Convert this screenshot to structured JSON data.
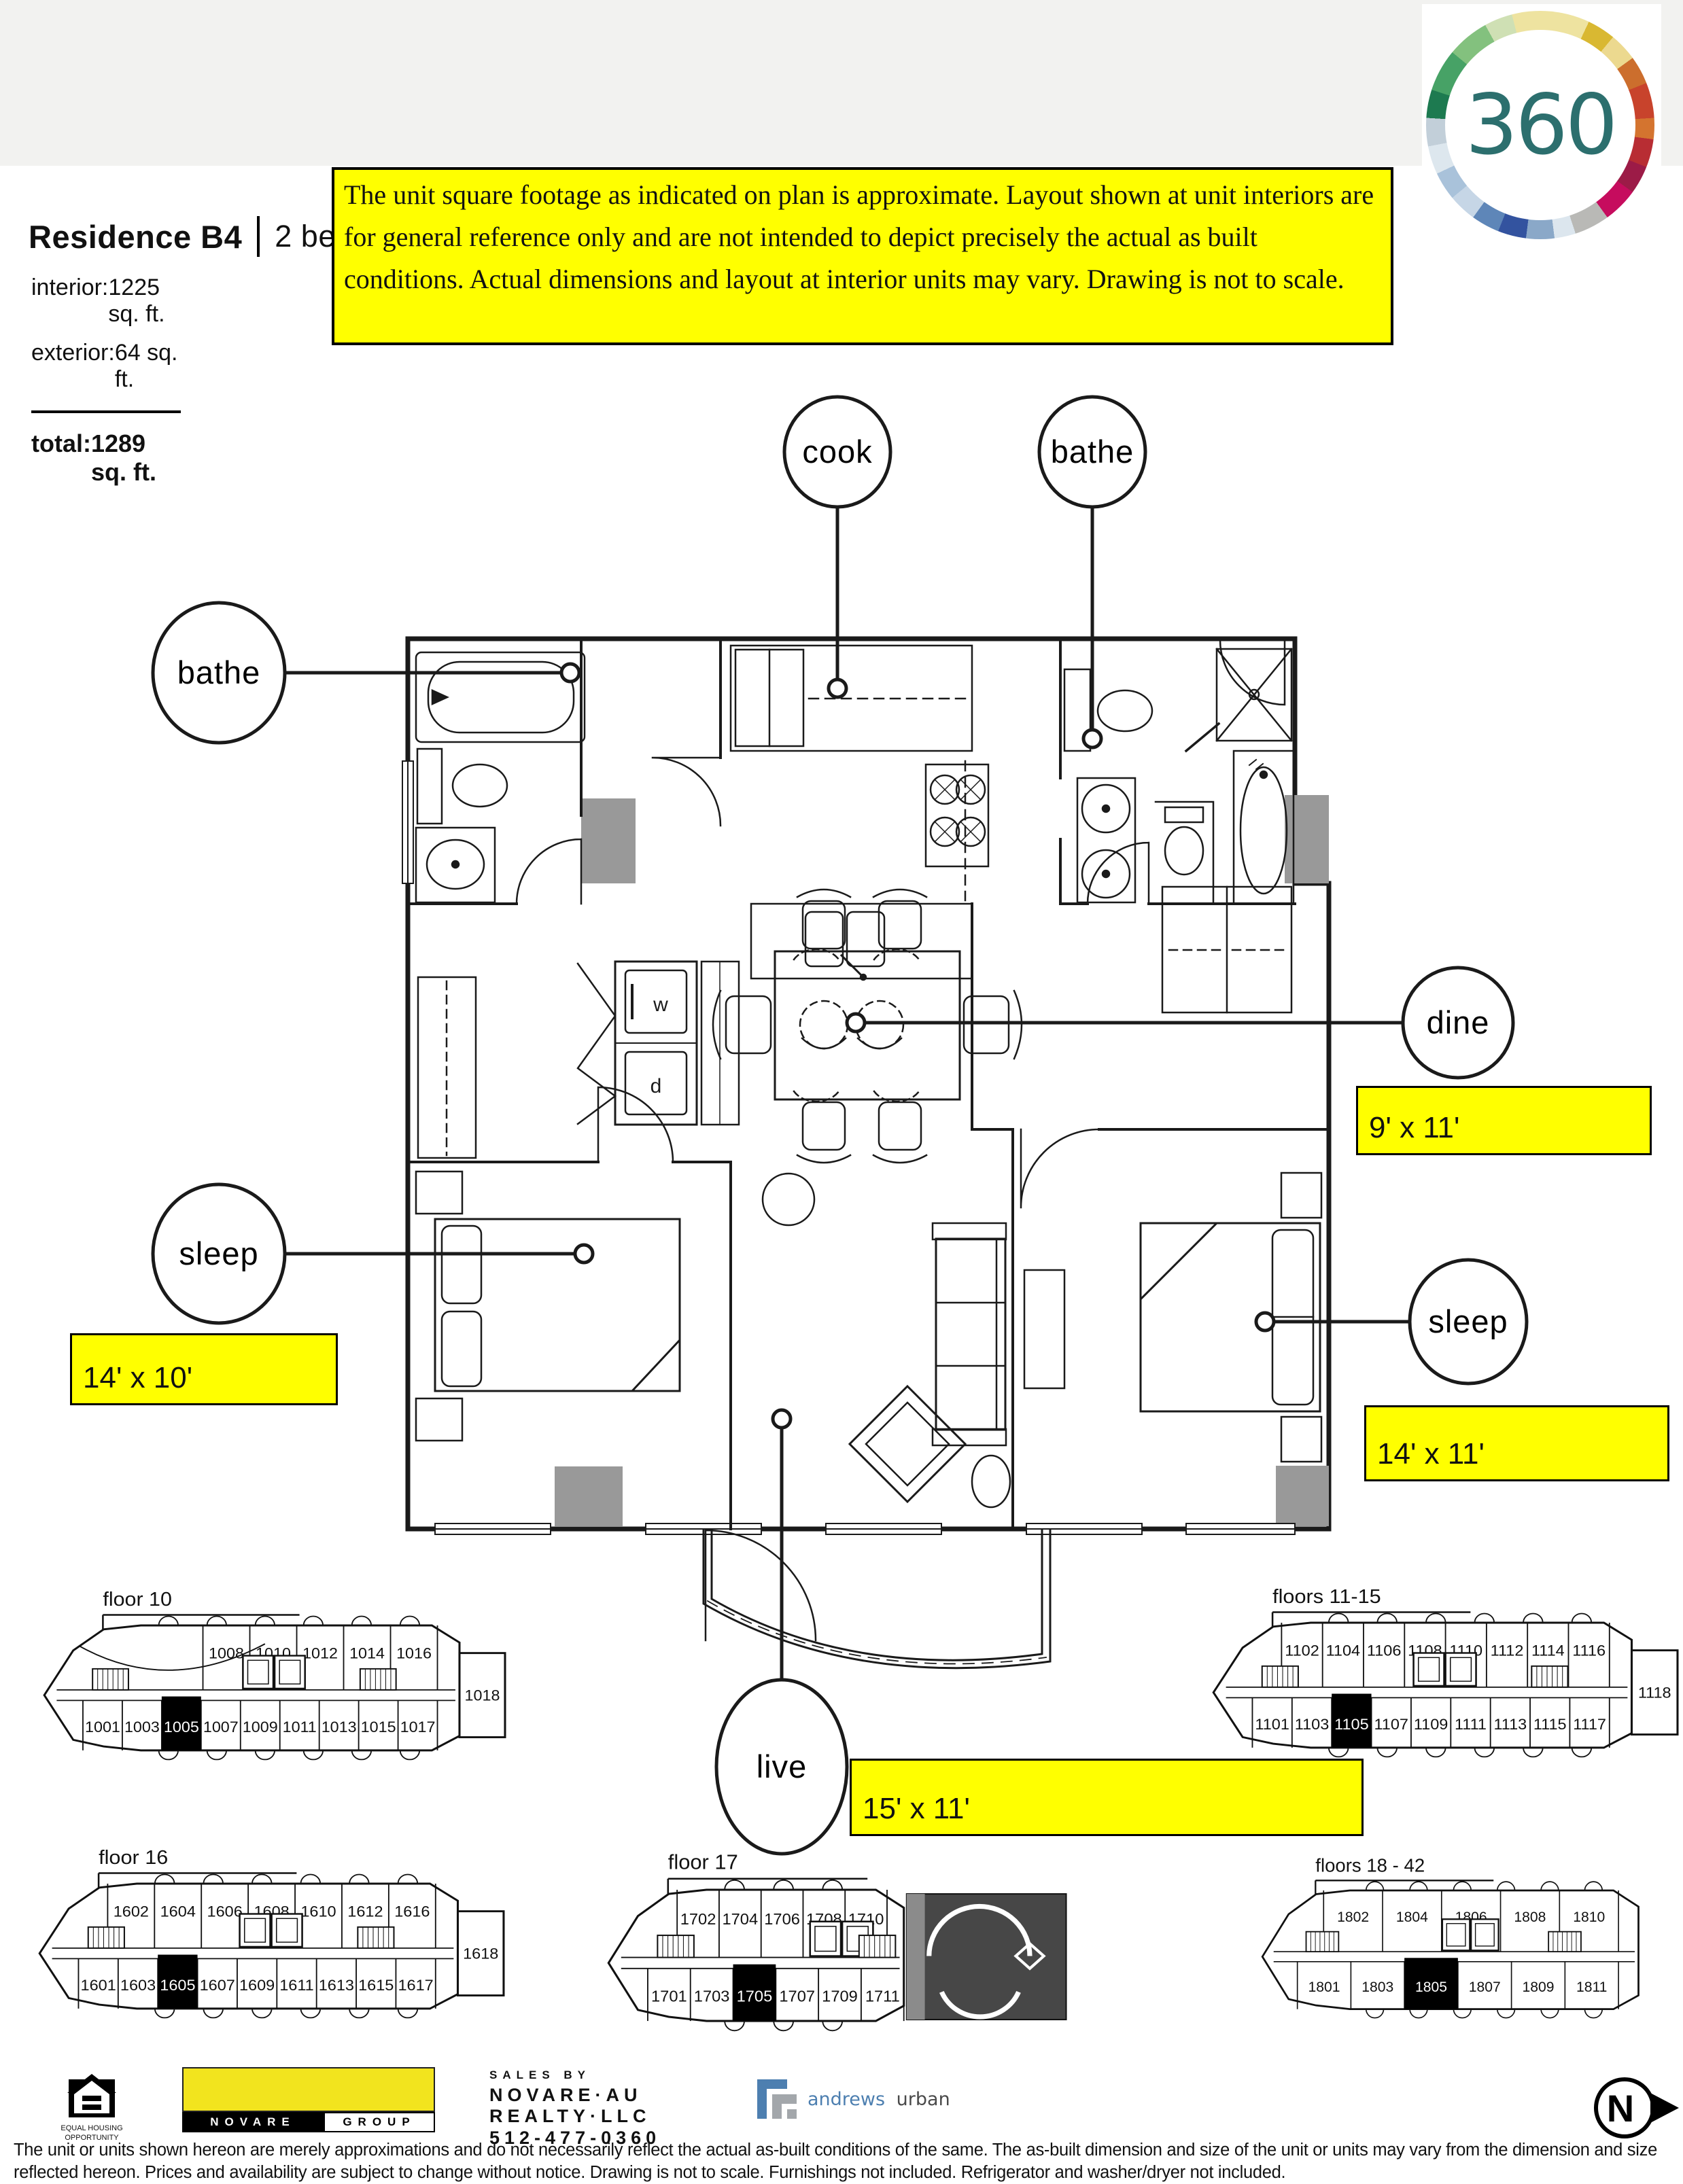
{
  "header": {
    "residence": "Residence B4",
    "subtitle": "2 bedroom + 2 bath",
    "stats": [
      {
        "label": "interior:",
        "value": "1225 sq. ft."
      },
      {
        "label": "exterior:",
        "value": "64 sq. ft."
      }
    ],
    "total_label": "total:",
    "total_value": "1289 sq. ft.",
    "disclaimer": "The unit square footage as indicated on plan is approximate.  Layout shown at unit interiors are for general reference only and are not intended to depict precisely the actual as built conditions.  Actual dimensions and layout at interior units may vary.  Drawing is not to scale."
  },
  "logo360": {
    "text": "360"
  },
  "plan": {
    "callouts": {
      "cook": "cook",
      "bathe_top": "bathe",
      "bathe_left": "bathe",
      "dine": "dine",
      "sleep_left": "sleep",
      "sleep_right": "sleep",
      "live": "live"
    },
    "dims": {
      "dine": "9' x 11'",
      "sleep_left": "14' x 10'",
      "sleep_right": "14' x 11'",
      "live": "15' x 11'"
    },
    "labels": {
      "washer": "w",
      "dryer": "d"
    }
  },
  "floorplates": [
    {
      "id": "floor10",
      "label": "floor 10",
      "top": [
        "1008",
        "1010",
        "1012",
        "1014",
        "1016"
      ],
      "bottom": [
        "1001",
        "1003",
        "1005",
        "1007",
        "1009",
        "1011",
        "1013",
        "1015",
        "1017"
      ],
      "right": "1018",
      "black": "1005"
    },
    {
      "id": "floors11_15",
      "label": "floors 11-15",
      "top": [
        "1102",
        "1104",
        "1106",
        "1108",
        "1110",
        "1112",
        "1114",
        "1116"
      ],
      "bottom": [
        "1101",
        "1103",
        "1105",
        "1107",
        "1109",
        "1111",
        "1113",
        "1115",
        "1117"
      ],
      "right": "1118",
      "black": "1105"
    },
    {
      "id": "floor16",
      "label": "floor 16",
      "top": [
        "1602",
        "1604",
        "1606",
        "1608",
        "1610",
        "1612",
        "1616"
      ],
      "bottom": [
        "1601",
        "1603",
        "1605",
        "1607",
        "1609",
        "1611",
        "1613",
        "1615",
        "1617"
      ],
      "right": "1618",
      "black": "1605"
    },
    {
      "id": "floor17",
      "label": "floor 17",
      "top": [
        "1702",
        "1704",
        "1706",
        "1708",
        "1710"
      ],
      "bottom": [
        "1701",
        "1703",
        "1705",
        "1707",
        "1709",
        "1711"
      ],
      "right": null,
      "black": "1705"
    },
    {
      "id": "floors18_42",
      "label": "floors 18 - 42",
      "top": [
        "1802",
        "1804",
        "1806",
        "1808",
        "1810"
      ],
      "bottom": [
        "1801",
        "1803",
        "1805",
        "1807",
        "1809",
        "1811"
      ],
      "right": null,
      "black": "1805"
    }
  ],
  "footer": {
    "eho_line1": "EQUAL HOUSING",
    "eho_line2": "OPPORTUNITY",
    "novare_name": "NOVARE",
    "novare_group": "GROUP",
    "sales_by": "SALES BY",
    "sales_l1": "NOVARE·AU",
    "sales_l2": "REALTY·LLC",
    "sales_l3": "512-477-0360",
    "andrews": "andrews",
    "urban": "urban",
    "north": "N",
    "legal": "The unit or units shown hereon are merely approximations and do not necessarily reflect the actual as-built conditions of the same. The as-built dimension and size of the unit or units may vary from the dimension and size reflected hereon. Prices and availability are subject to change without notice. Drawing is not to scale. Furnishings not included. Refrigerator and washer/dryer not included."
  }
}
